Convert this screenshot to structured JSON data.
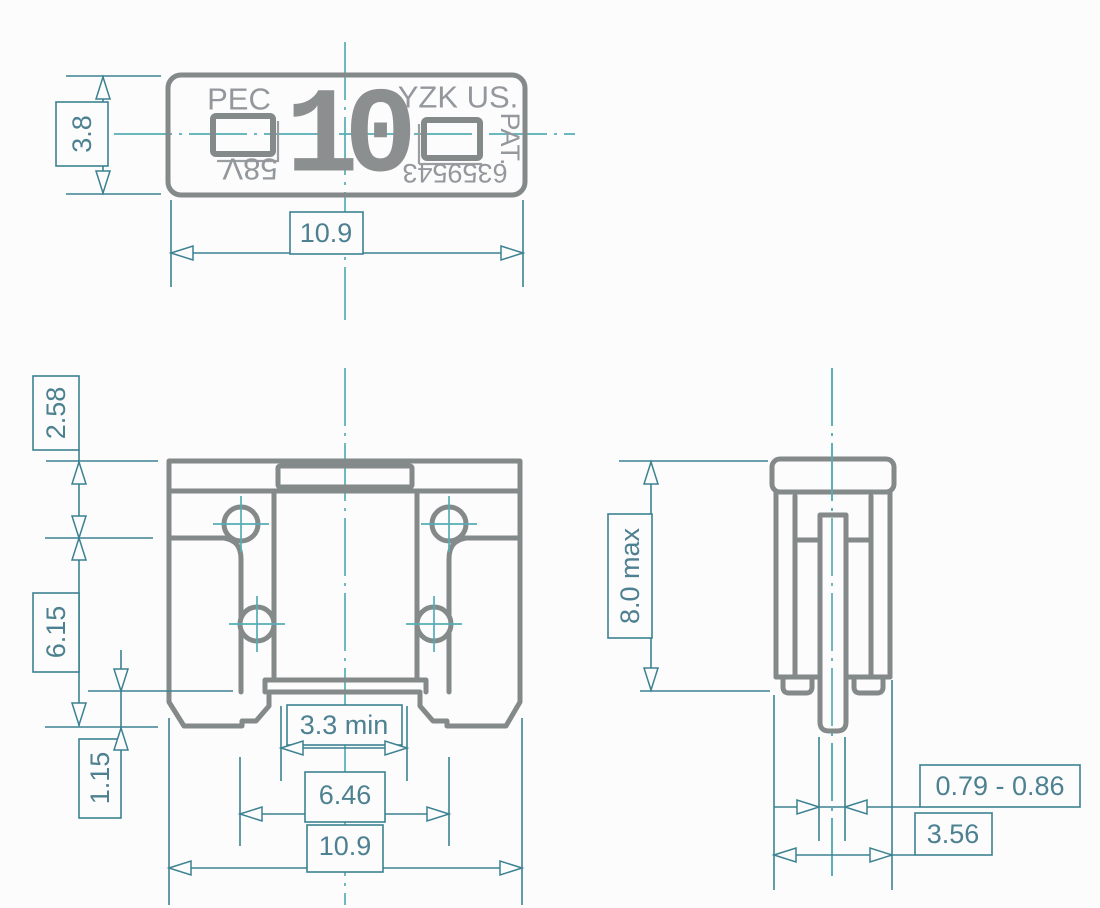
{
  "colors": {
    "background": "#fcfcfc",
    "part_line": "#848989",
    "part_text": "#94989d",
    "dimension_line": "#3c8191",
    "dimension_text": "#4d8191",
    "centerline": "#55adb5"
  },
  "top_view": {
    "markings": {
      "brand": "PEC",
      "amp_rating": "10",
      "manufacturer": "YZK US.",
      "patent_label": "PAT.",
      "voltage": "58V",
      "patent_number": "6359543"
    },
    "dims": {
      "height": "3.8",
      "width": "10.9"
    }
  },
  "front_view": {
    "dims": {
      "cap_height": "2.58",
      "body_height": "6.15",
      "foot_height": "1.15",
      "probe_gap_min": "3.3 min",
      "terminal_span": "6.46",
      "width": "10.9"
    }
  },
  "side_view": {
    "dims": {
      "height_max": "8.0 max",
      "terminal_thickness": "0.79 - 0.86",
      "depth": "3.56"
    }
  }
}
